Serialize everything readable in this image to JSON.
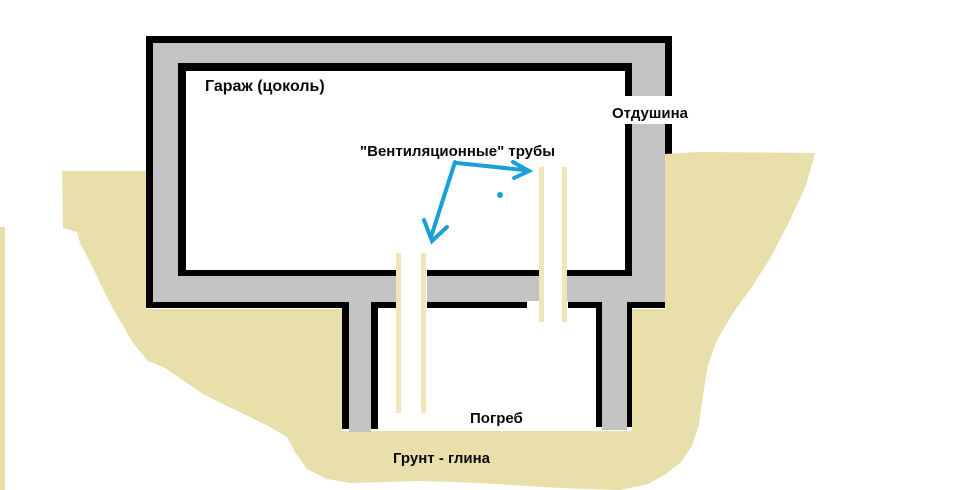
{
  "labels": {
    "garage": "Гараж (цоколь)",
    "vent": "Отдушина",
    "pipes": "\"Вентиляционные\" трубы",
    "cellar": "Погреб",
    "soil": "Грунт - глина"
  },
  "colors": {
    "background": "#ffffff",
    "outline": "#000000",
    "wall_fill": "#c3c3c4",
    "soil": "#e9dfaa",
    "pipe": "#efe6ba",
    "arrow": "#1b9fd8"
  }
}
